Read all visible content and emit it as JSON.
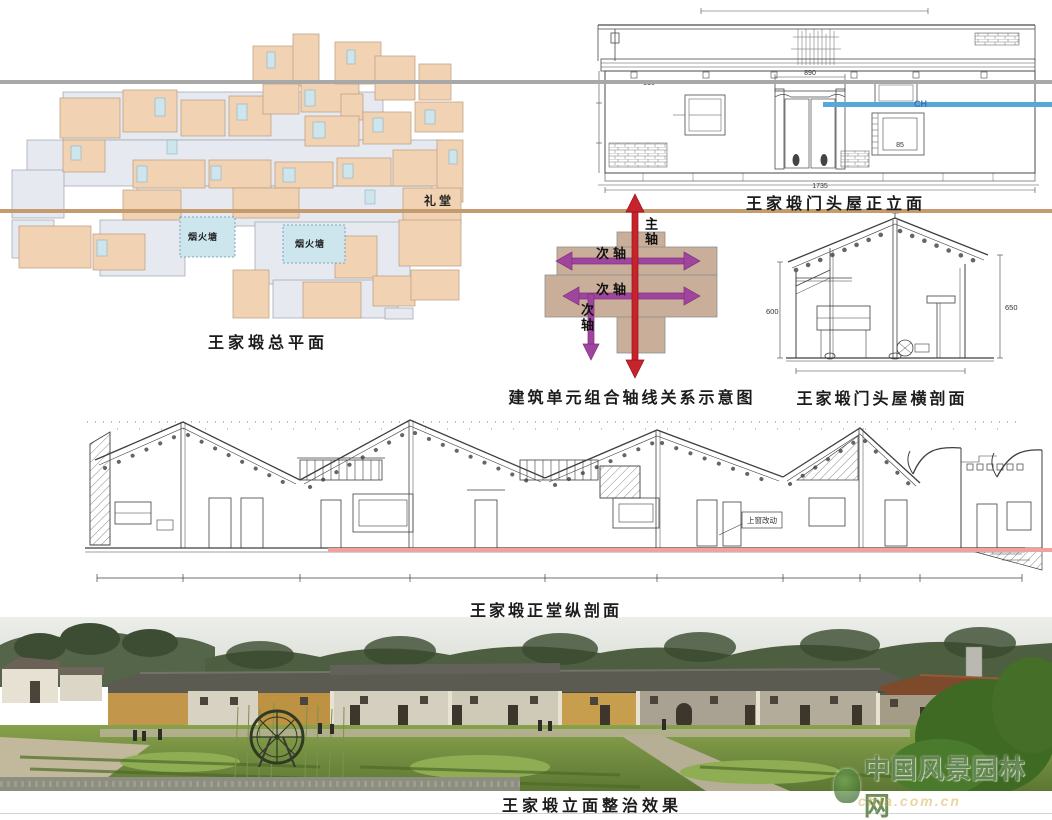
{
  "captions": {
    "site_plan": "王家塅总平面",
    "front_elevation": "王家塅门头屋正立面",
    "axis_diagram": "建筑单元组合轴线关系示意图",
    "cross_section": "王家塅门头屋横剖面",
    "long_section": "王家塅正堂纵剖面",
    "photo": "王家塅立面整治效果"
  },
  "site_plan": {
    "hall_label": "礼堂",
    "pond_label_1": "烟火塘",
    "pond_label_2": "烟火塘",
    "colors": {
      "building": "#f1d3b3",
      "courtyard": "#e7e9f1",
      "pond": "#cde6ee"
    }
  },
  "axis_diagram": {
    "main_axis_label": "主轴",
    "secondary_axis_label_1": "次轴",
    "secondary_axis_label_2": "次轴",
    "secondary_axis_label_3": "次轴",
    "colors": {
      "main_axis": "#c8232c",
      "secondary_axis": "#a0459e",
      "block": "#c9ae99"
    }
  },
  "front_elevation": {
    "dims": {
      "overall_width": "1735",
      "door_width": "890",
      "left_height": "510",
      "window_width": "85",
      "level_mark": "CH"
    }
  },
  "cross_section": {
    "dims": {
      "left_height": "600",
      "right_height": "650"
    }
  },
  "long_section": {
    "note": "上窗改动"
  },
  "photo": {
    "watermark_title": "中国风景园林网",
    "watermark_url": "chla.com.cn"
  },
  "guide_lines": {
    "gray": "#a8a8a8",
    "tan": "#c49b6e",
    "blue": "#58a7da",
    "red": "#f2a29c"
  }
}
